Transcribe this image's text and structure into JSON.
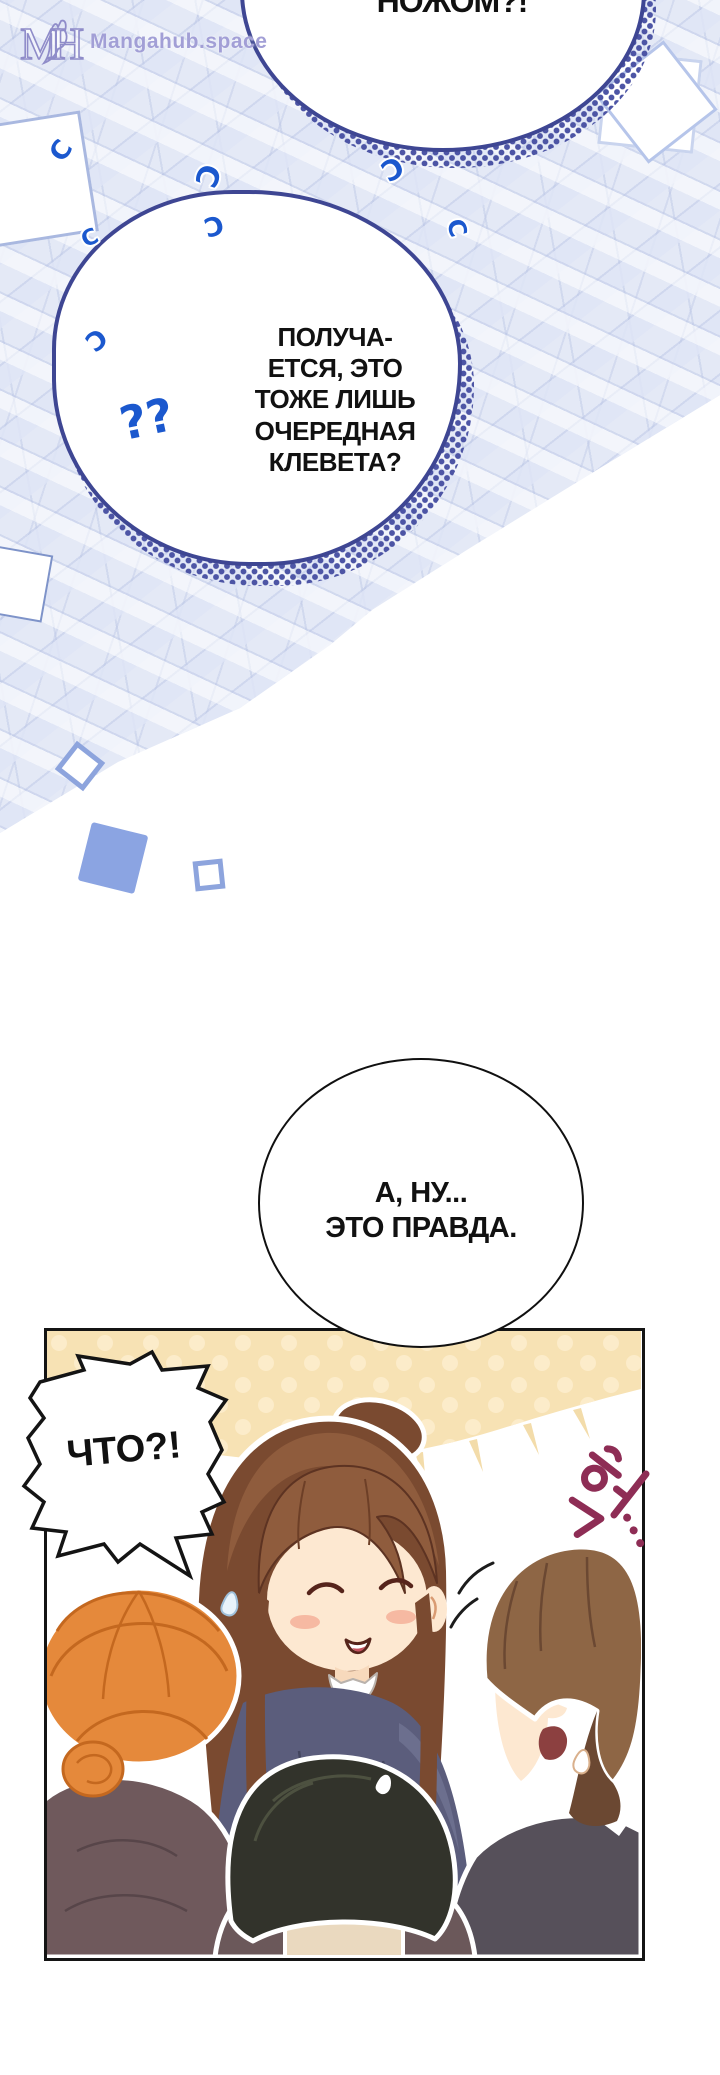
{
  "watermark": {
    "logo_m": "M",
    "logo_h": "H",
    "site": "Mangahub.space"
  },
  "bubbles": {
    "top": {
      "text": "НОЖОМ?!"
    },
    "main": {
      "lines": [
        "ПОЛУЧА-",
        "ЕТСЯ, ЭТО",
        "ТОЖЕ ЛИШЬ",
        "ОЧЕРЕДНАЯ",
        "КЛЕВЕТА?"
      ]
    },
    "circle": {
      "lines": [
        "А, НУ...",
        "ЭТО ПРАВДА."
      ]
    },
    "shout": {
      "text": "ЧТО?!"
    }
  },
  "marks": {
    "double_question": "??",
    "curl_glyph": "C"
  },
  "sfx": {
    "text": "헉..."
  },
  "colors": {
    "outline_navy": "#3e4693",
    "halftone_dot": "#4d55a5",
    "question_blue": "#1b58ce",
    "square_fill": "#8ba4e2",
    "square_outline": "#8da4dd",
    "panel_cream": "#f7e2b4",
    "girl_hair": "#8f5c3d",
    "woman_hair": "#e5893b",
    "man_hair": "#8e6645",
    "sfx_maroon": "#8e2d55",
    "watermark_purple": "#a29fd6"
  }
}
